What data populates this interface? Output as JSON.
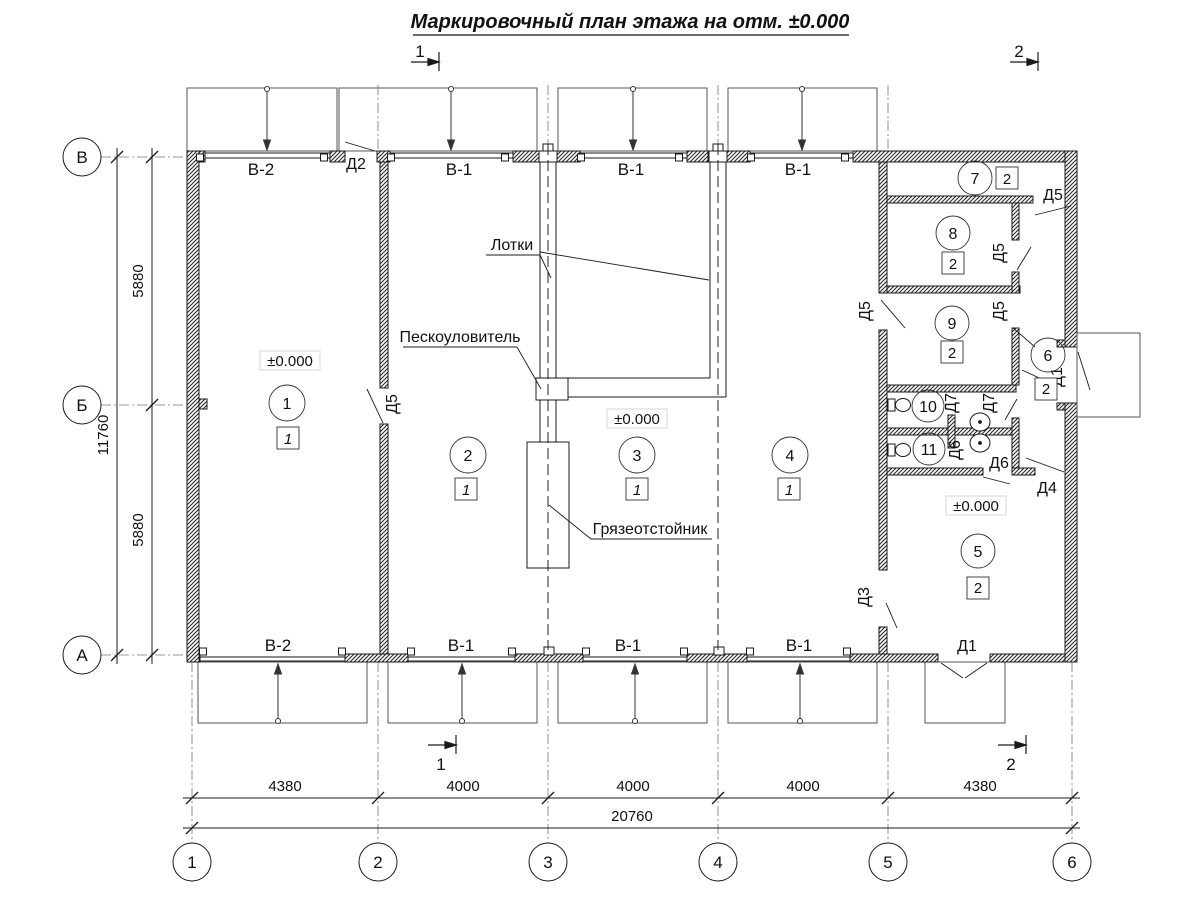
{
  "title": "Маркировочный план этажа на отм. ±0.000",
  "section_marks": {
    "top_1": "1",
    "top_2": "2",
    "bottom_1": "1",
    "bottom_2": "2"
  },
  "grid": {
    "columns": [
      "1",
      "2",
      "3",
      "4",
      "5",
      "6"
    ],
    "rows": [
      "В",
      "Б",
      "А"
    ]
  },
  "dimensions": {
    "col_spans": [
      "4380",
      "4000",
      "4000",
      "4000",
      "4380"
    ],
    "total_width": "20760",
    "row_spans": [
      "5880",
      "5880"
    ],
    "total_height": "11760"
  },
  "gates": {
    "top": [
      "В-2",
      "В-1",
      "В-1",
      "В-1"
    ],
    "bottom": [
      "В-2",
      "В-1",
      "В-1",
      "В-1"
    ]
  },
  "doors": {
    "d2": "Д2",
    "d5_room1": "Д5",
    "d5_room7": "Д5",
    "d5_room8": "Д5",
    "d5_room9_left": "Д5",
    "d5_room9_right": "Д5",
    "d7_left": "Д7",
    "d7_right": "Д7",
    "d6_left": "Д6",
    "d6_right": "Д6",
    "d4": "Д4",
    "d3": "Д3",
    "d1_side": "Д1",
    "d1_bottom": "Д1"
  },
  "rooms": [
    {
      "number": "1",
      "finish": "1",
      "elevation": "±0.000"
    },
    {
      "number": "2",
      "finish": "1"
    },
    {
      "number": "3",
      "finish": "1",
      "elevation": "±0.000"
    },
    {
      "number": "4",
      "finish": "1"
    },
    {
      "number": "5",
      "finish": "2",
      "elevation": "±0.000"
    },
    {
      "number": "6",
      "finish": "2"
    },
    {
      "number": "7",
      "finish": "2"
    },
    {
      "number": "8",
      "finish": "2"
    },
    {
      "number": "9",
      "finish": "2"
    },
    {
      "number": "10"
    },
    {
      "number": "11"
    }
  ],
  "annotations": {
    "trays": "Лотки",
    "sand_trap": "Пескоуловитель",
    "mud_trap": "Грязеотстойник"
  }
}
